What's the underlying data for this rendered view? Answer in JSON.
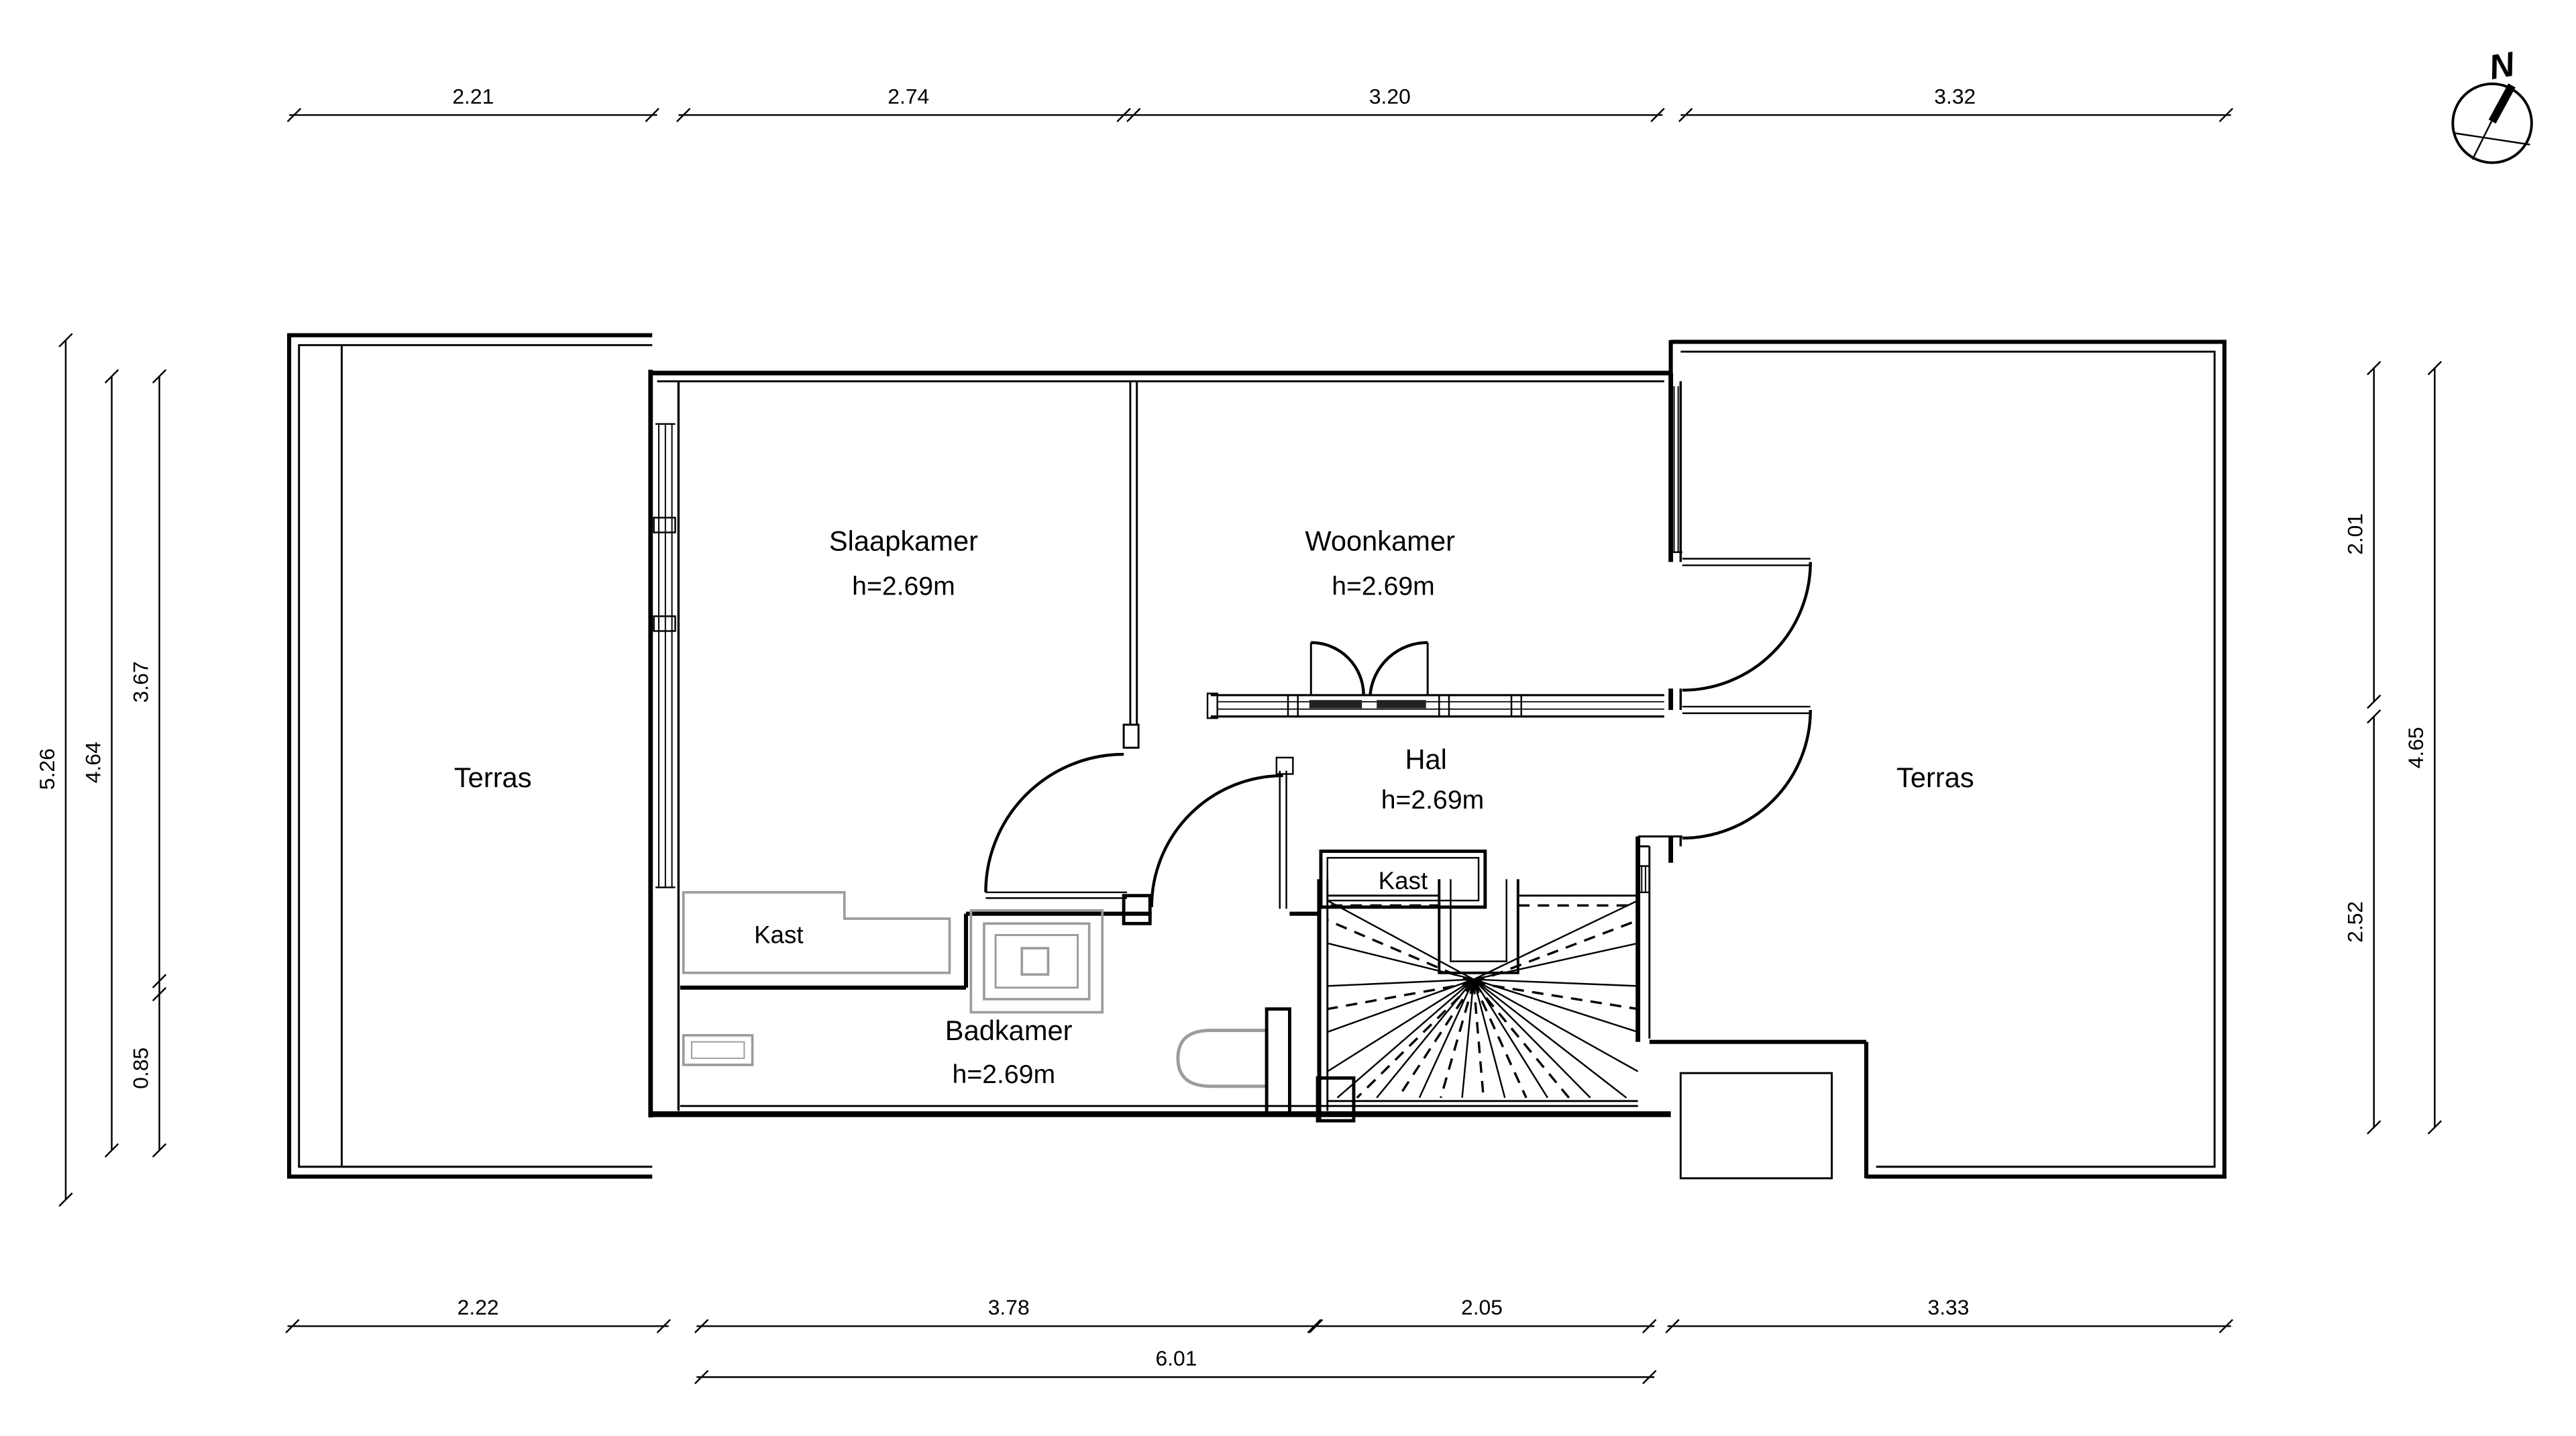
{
  "compass": {
    "north_label": "N"
  },
  "rooms": {
    "slaapkamer": {
      "name": "Slaapkamer",
      "height": "h=2.69m"
    },
    "woonkamer": {
      "name": "Woonkamer",
      "height": "h=2.69m"
    },
    "hal": {
      "name": "Hal",
      "height": "h=2.69m"
    },
    "badkamer": {
      "name": "Badkamer",
      "height": "h=2.69m"
    },
    "terras_left": {
      "name": "Terras"
    },
    "terras_right": {
      "name": "Terras"
    },
    "kast_hal": {
      "name": "Kast"
    },
    "kast_slaapkamer": {
      "name": "Kast"
    }
  },
  "dims": {
    "top": [
      "2.21",
      "2.74",
      "3.20",
      "3.32"
    ],
    "bottom": [
      "2.22",
      "3.78",
      "2.05",
      "3.33"
    ],
    "bottom_total": "6.01",
    "left_outer": "5.26",
    "left_mid": "4.64",
    "left_upper": "3.67",
    "left_lower": "0.85",
    "right_upper": "2.01",
    "right_lower": "2.52",
    "right_outer": "4.65"
  },
  "colors": {
    "line": "#000000",
    "fixture": "#9c9c9c",
    "background": "#ffffff"
  }
}
